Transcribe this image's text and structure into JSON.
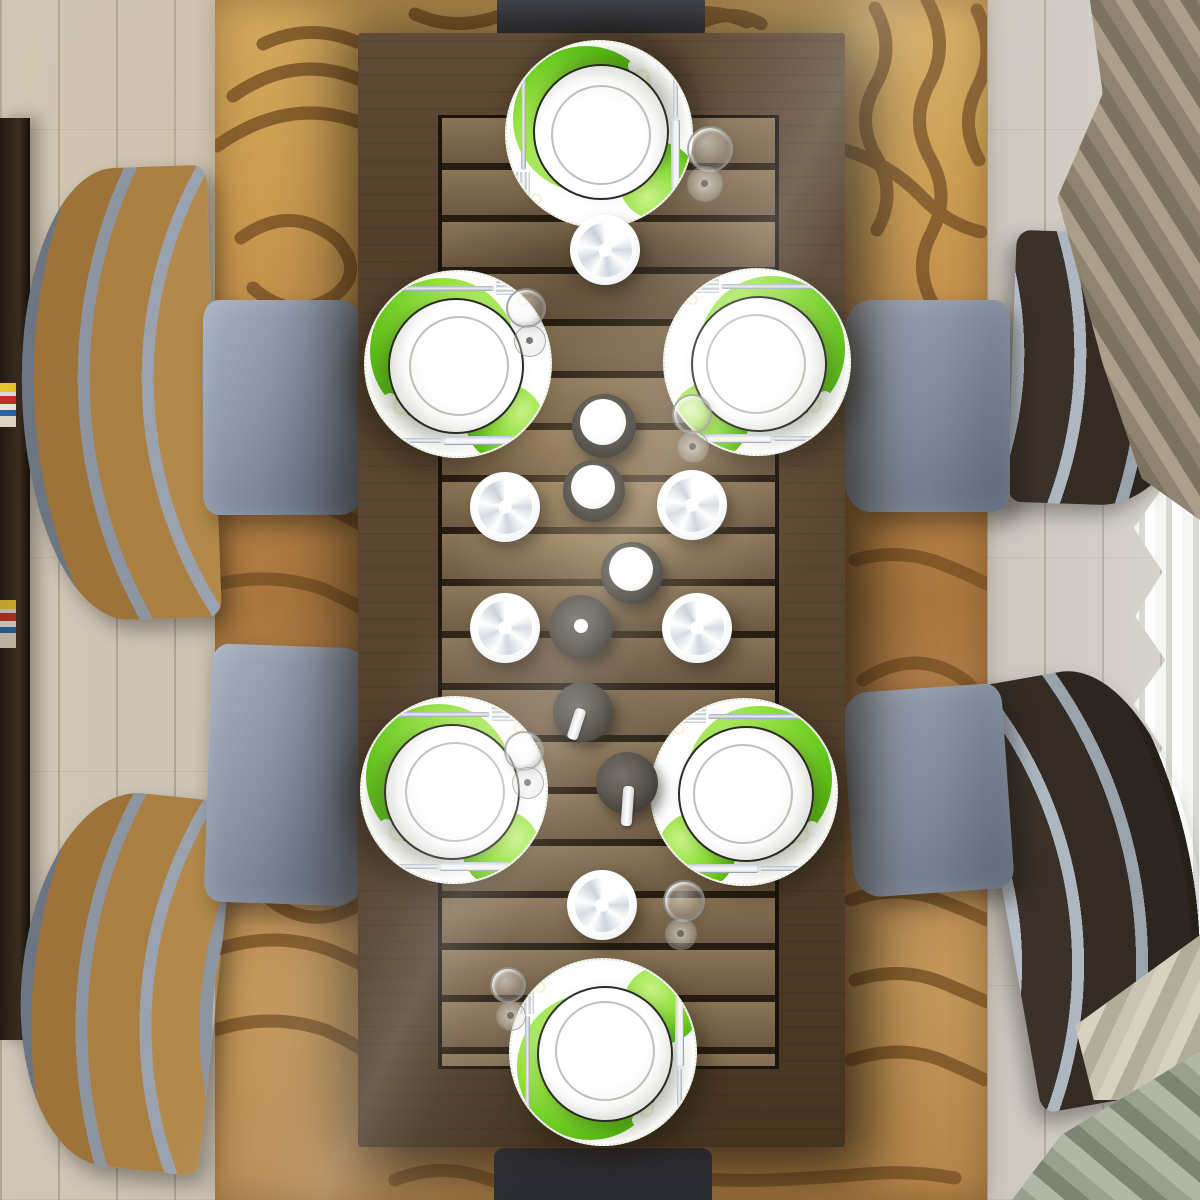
{
  "scene": {
    "title": "Overhead view of a dark wood dining table set for six with green-apple print placemats",
    "view": "top-down",
    "medium": "interior 3D render photograph",
    "floor": {
      "material": "light washed wood planks",
      "color": "#cbc3b6"
    },
    "rug": {
      "description": "camel area rug with dark brown freehand swirl and wave lines",
      "base_color": "#c2914f",
      "pattern_color": "#7a5226"
    },
    "sideboard": {
      "description": "dark wood sideboard along the left edge with a stack of magazines",
      "color": "#2e2318"
    },
    "table": {
      "shape": "rectangular",
      "description": "dark stained wood table with slatted plank top and solid border",
      "border_color": "#52402c",
      "slat_color": "#7b674b",
      "seats": 6
    },
    "place_settings": [
      {
        "position": "north head",
        "placemat": "round mat printed with green apples and white blossoms",
        "plate": "white dinner plate",
        "cutlery": [
          "fork",
          "knife"
        ]
      },
      {
        "position": "west upper",
        "placemat": "round mat printed with green apples and white blossoms",
        "plate": "white dinner plate",
        "cutlery": [
          "fork",
          "knife"
        ]
      },
      {
        "position": "east upper",
        "placemat": "round mat printed with green apples and white blossoms",
        "plate": "white dinner plate",
        "cutlery": [
          "fork",
          "knife"
        ]
      },
      {
        "position": "west lower",
        "placemat": "round mat printed with green apples and white blossoms",
        "plate": "white dinner plate",
        "cutlery": [
          "fork",
          "knife"
        ]
      },
      {
        "position": "east lower",
        "placemat": "round mat printed with green apples and white blossoms",
        "plate": "white dinner plate",
        "cutlery": [
          "fork",
          "knife"
        ]
      },
      {
        "position": "south head",
        "placemat": "round mat printed with green apples and white blossoms",
        "plate": "white dinner plate",
        "cutlery": [
          "fork",
          "knife"
        ]
      }
    ],
    "centerpiece": {
      "swirl_candles_on_saucers": 6,
      "pillar_candles_in_smoked_glass_holders": 3,
      "votive_in_wide_dark_holder": 1,
      "dark_candlesticks_with_white_candles": 2
    },
    "wine_glasses": 6,
    "chairs": [
      {
        "position": "west upper",
        "back": "curved golden oak slats with grey rails",
        "seat": "blue-grey leather"
      },
      {
        "position": "west lower",
        "back": "curved golden oak slats with grey rails",
        "seat": "blue-grey leather"
      },
      {
        "position": "east upper",
        "back": "curved espresso slats with silver rails",
        "seat": "blue-grey leather"
      },
      {
        "position": "east lower",
        "back": "curved espresso slats with silver rails",
        "seat": "blue-grey leather"
      },
      {
        "position": "north head",
        "seat": "dark grey"
      },
      {
        "position": "south head",
        "seat": "dark grey"
      }
    ],
    "curtains": [
      {
        "position": "top right",
        "color": "#9a8f7b",
        "style": "draped taupe panel"
      },
      {
        "position": "right",
        "color": "#f2f2ef",
        "style": "white sheer with vertical waves"
      },
      {
        "position": "bottom right",
        "color": "#969c8b",
        "style": "sage and beige gathered folds on the floor"
      }
    ]
  },
  "palette": {
    "apple_green": "#6fd026",
    "placemat_white": "#f7f9f4",
    "plate_white": "#ffffff",
    "table_wood_dark": "#52402c",
    "table_slat": "#7b674b",
    "rug_camel": "#c2914f",
    "rug_line_brown": "#7a5226",
    "floor_wood": "#cbc3b6",
    "seat_blue_grey": "#8893a3",
    "chair_oak": "#b2894a",
    "chair_espresso": "#3a312a",
    "candle_white": "#ffffff",
    "holder_smoke": "#4a453f"
  }
}
